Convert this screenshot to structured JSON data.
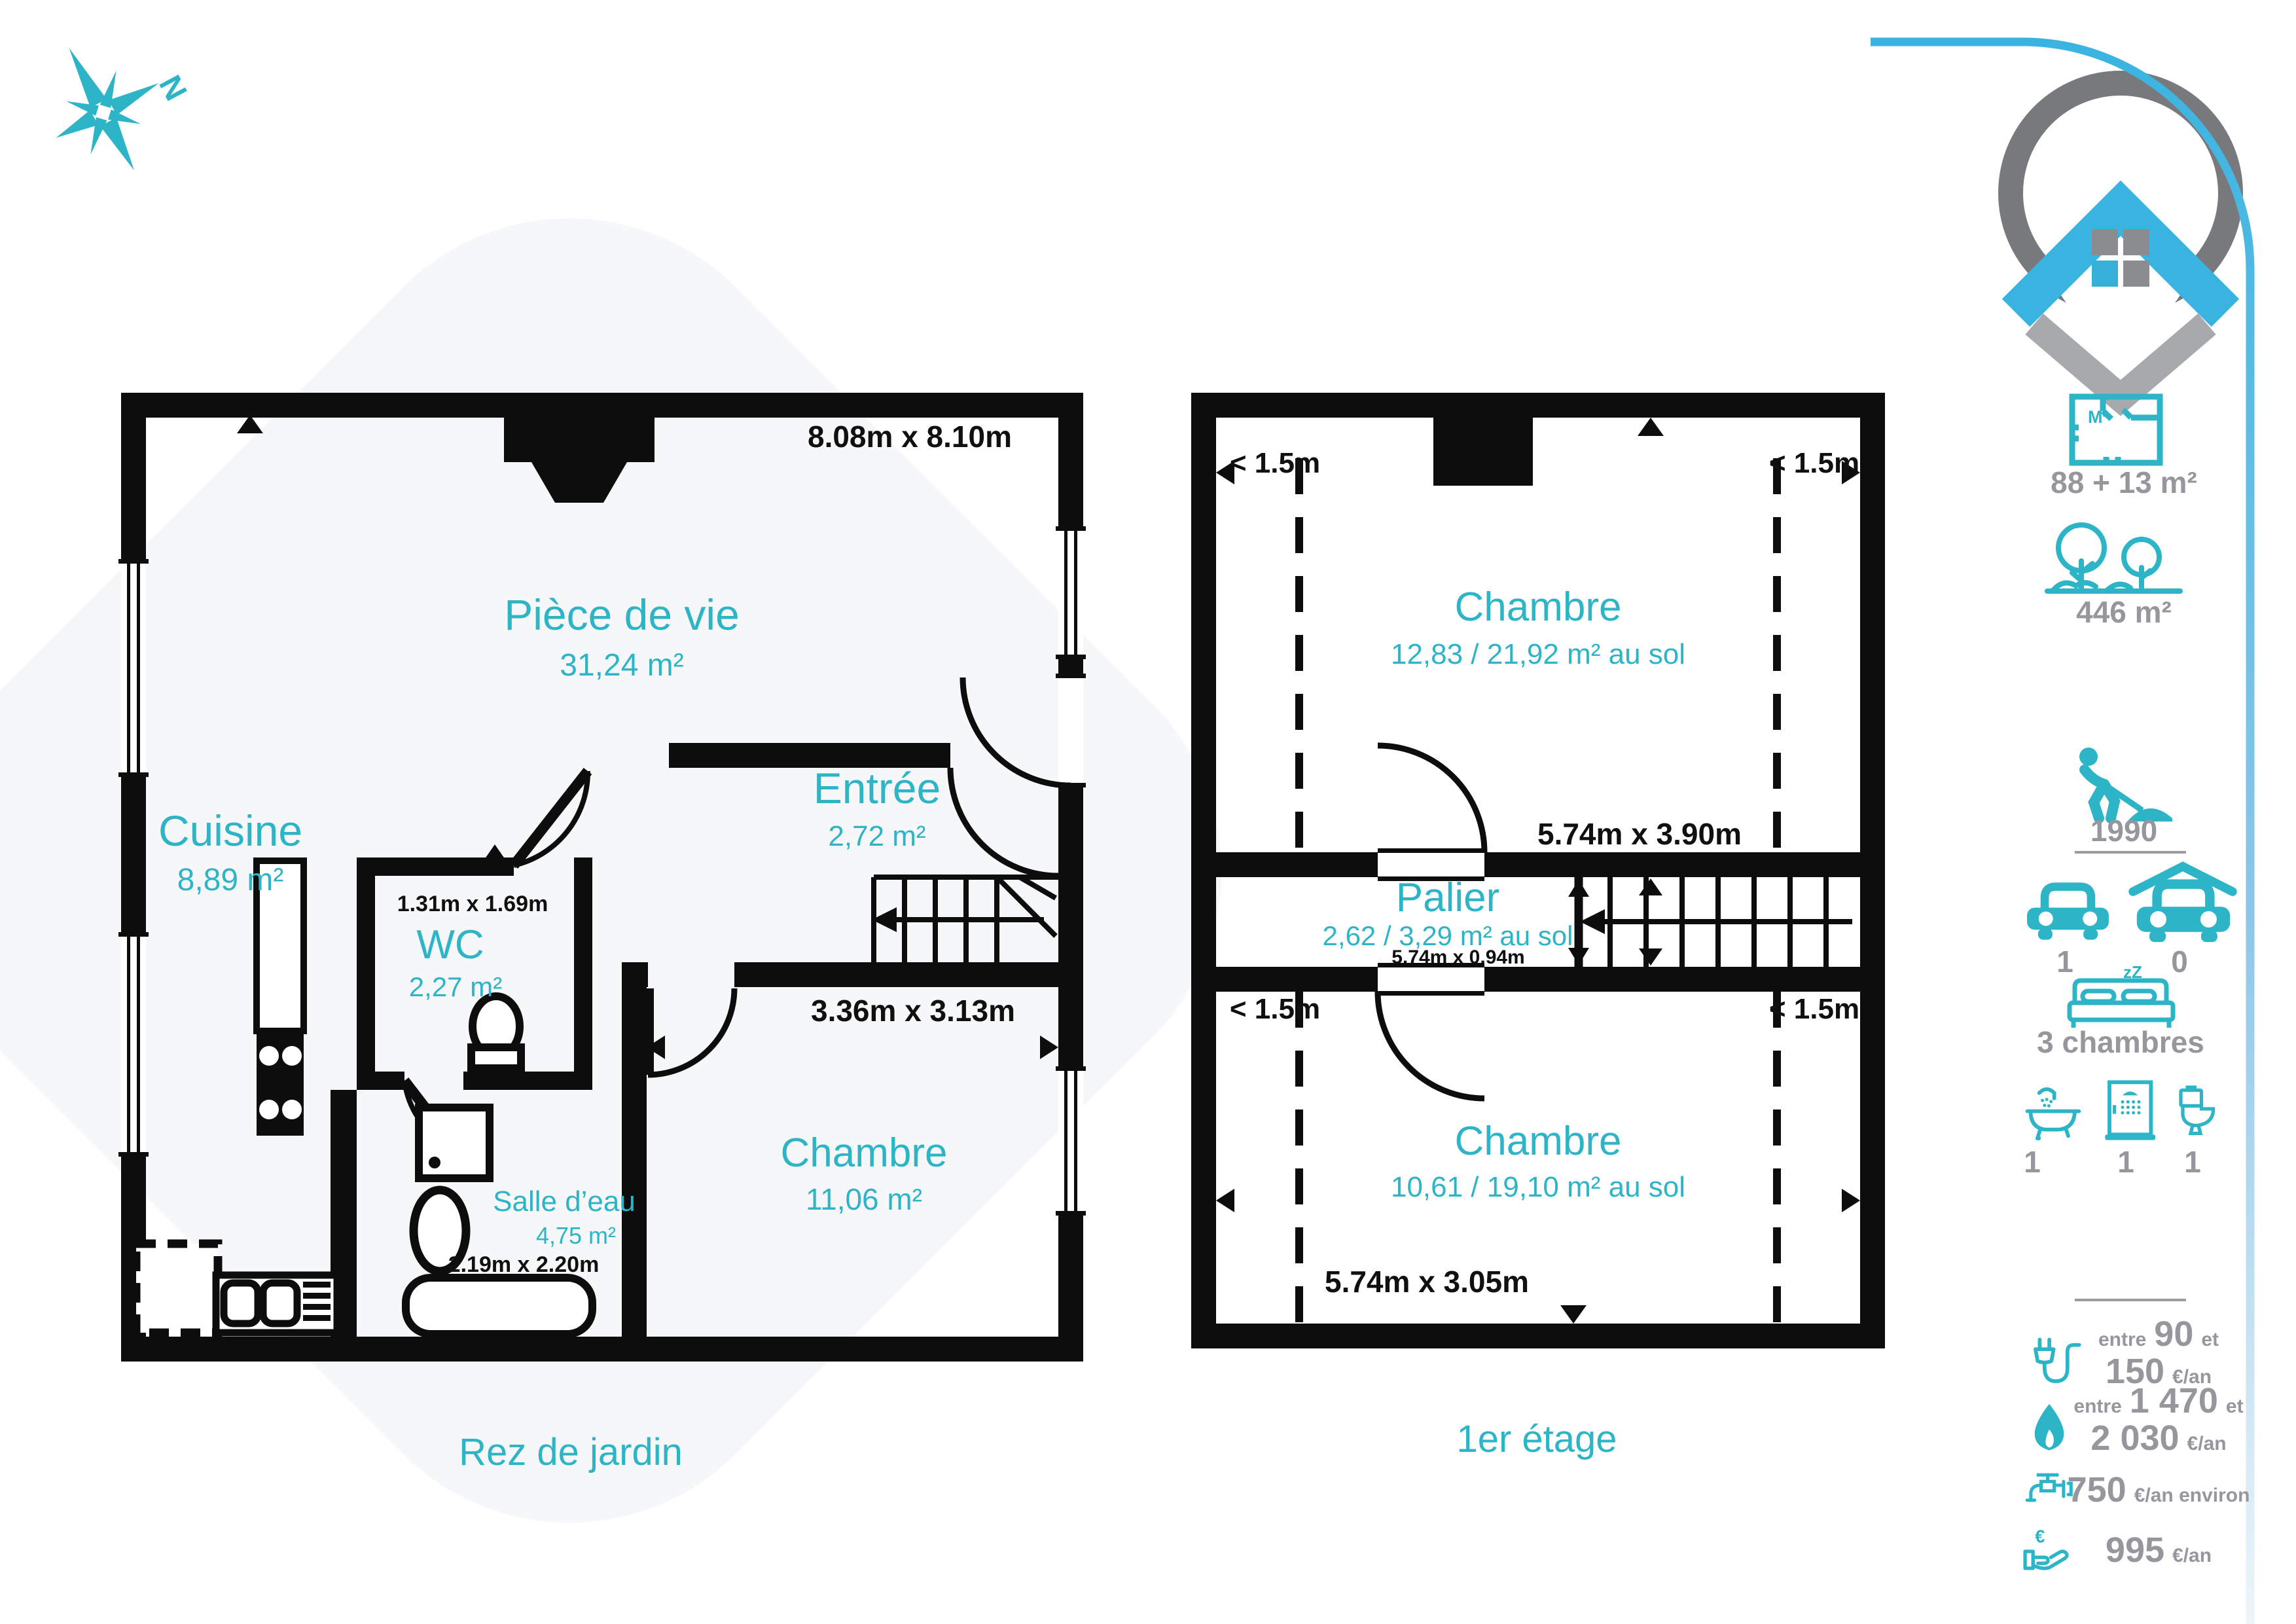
{
  "colors": {
    "teal": "#2db4c7",
    "logo_blue": "#39b4e0",
    "logo_gray": "#77797d",
    "logo_light_gray": "#a7a9ac",
    "text_gray": "#95979c",
    "wall_black": "#0d0d0d"
  },
  "compass": {
    "label": "N"
  },
  "floor1": {
    "caption": "Rez de jardin",
    "dim_overall": "8.08m x 8.10m",
    "rooms": {
      "living": {
        "name": "Pièce de vie",
        "area": "31,24 m²"
      },
      "kitchen": {
        "name": "Cuisine",
        "area": "8,89 m²"
      },
      "entry": {
        "name": "Entrée",
        "area": "2,72 m²"
      },
      "wc": {
        "name": "WC",
        "area": "2,27 m²",
        "dim": "1.31m x 1.69m"
      },
      "bathroom": {
        "name": "Salle d’eau",
        "area": "4,75 m²",
        "dim": "2.19m x 2.20m"
      },
      "bedroom": {
        "name": "Chambre",
        "area": "11,06 m²",
        "dim": "3.36m x 3.13m"
      }
    }
  },
  "floor2": {
    "caption": "1er étage",
    "height_note": "< 1.5m",
    "rooms": {
      "bedroom1": {
        "name": "Chambre",
        "area": "12,83 / 21,92 m² au sol",
        "dim": "5.74m x 3.90m"
      },
      "landing": {
        "name": "Palier",
        "area": "2,62 / 3,29 m² au sol",
        "dim": "5.74m x 0.94m"
      },
      "bedroom2": {
        "name": "Chambre",
        "area": "10,61 / 19,10 m² au sol",
        "dim": "5.74m x 3.05m"
      }
    }
  },
  "sidebar": {
    "floor_area": {
      "icon_label": "M²",
      "value": "88 + 13 m²"
    },
    "land_area": {
      "value": "446 m²"
    },
    "year": {
      "value": "1990"
    },
    "parking": {
      "value": "1"
    },
    "garage": {
      "value": "0"
    },
    "bedrooms": {
      "value": "3 chambres",
      "zzz": "zZ"
    },
    "bath": {
      "value": "1"
    },
    "shower": {
      "value": "1"
    },
    "wc": {
      "value": "1"
    },
    "electricity": {
      "w1": "entre",
      "v1": "90",
      "w2": "et",
      "v2": "150",
      "unit": "€/an"
    },
    "gas": {
      "w1": "entre",
      "v1": "1 470",
      "w2": "et",
      "v2": "2 030",
      "unit": "€/an"
    },
    "water": {
      "v": "750",
      "unit": "€/an environ"
    },
    "tax": {
      "v": "995",
      "unit": "€/an",
      "euro": "€"
    }
  }
}
